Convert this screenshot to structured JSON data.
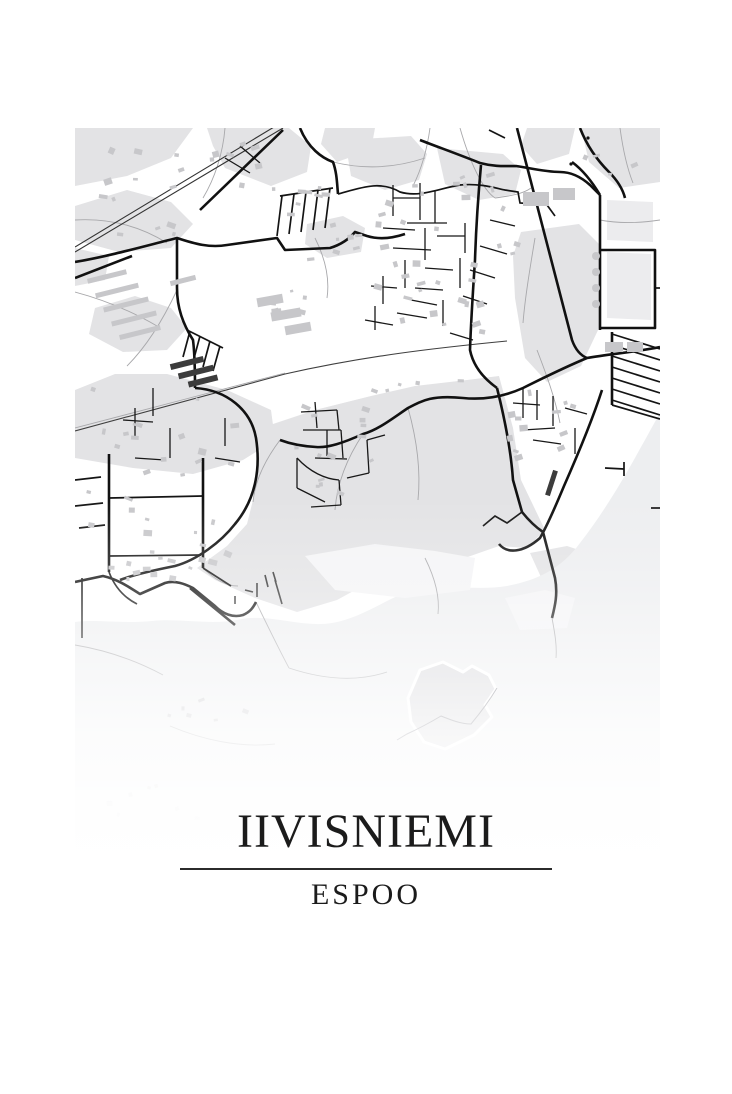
{
  "poster": {
    "title": "IIVISNIEMI",
    "subtitle": "ESPOO"
  },
  "colors": {
    "page": "#ffffff",
    "land": "#ffffff",
    "landuse": "#e3e3e5",
    "landuse_light": "#ececee",
    "water": "#edeef0",
    "shallow": "#f4f4f6",
    "building": "#c7c7ca",
    "building_dark": "#3c3c3c",
    "road_major": "#111111",
    "road_mid": "#141414",
    "road_minor": "#181818",
    "path": "#a8a8ab",
    "railway": "#333333",
    "highway": "#3f3f3f",
    "island_fill": "#d5d5d9",
    "island_trail": "#70707a",
    "pier": "#333333",
    "title_ink": "#1b1b1b",
    "divider": "#2b2b2b"
  },
  "map": {
    "plate": {
      "x": 75,
      "y": 128,
      "w": 585,
      "h": 740
    },
    "landuse": [
      "0,0 118,0 96,30 52,48 0,58",
      "132,0 214,0 236,18 232,44 196,58 150,40 138,18",
      "0,78 52,62 96,74 118,96 96,120 44,124 0,112",
      "250,0 300,0 296,22 262,34 246,16",
      "0,262 40,246 92,246 152,262 196,282 200,312 168,332 118,346 58,340 0,330",
      "270,12 336,8 352,26 344,52 310,62 276,48",
      "362,20 428,26 446,42 440,66 404,72 370,56",
      "296,268 340,258 392,252 424,248 438,300 446,352 470,402 452,420 424,418 384,432 342,438 302,450 262,472 222,484 180,470 140,452 122,440 152,418 172,396 179,368 184,330 186,300 240,282",
      "446,104 504,96 524,116 524,200 506,238 472,254 450,230 440,170 438,128",
      "506,0 585,0 585,54 544,60 514,34",
      "452,0 500,0 494,26 462,36 446,18",
      "20,180 60,168 96,180 112,200 92,222 48,224 14,206",
      "232,96 268,88 290,100 286,124 252,130 230,116",
      "455,425 492,418 522,428 512,453 470,458",
      "0,120 34,128 30,152 0,158"
    ],
    "landuse_light": [
      "532,72 578,74 578,114 532,112",
      "532,124 576,126 576,192 532,190",
      "60,560 140,545 205,562 185,602 100,607 42,590",
      "230,552 292,538 332,558 312,590 252,594",
      "0,600 40,590 70,602 58,632 12,636",
      "120,648 190,640 215,658 195,688 135,690 108,670"
    ],
    "water": "M585,285 C565,320 540,370 505,415 C485,442 462,452 432,458 C402,463 372,456 342,460 C312,470 287,490 257,495 C227,500 197,486 167,491 C137,498 107,490 77,493 C47,496 22,491 0,494 L0,740 L585,740 Z",
    "shallow": [
      "230,428 300,416 360,423 400,430 395,462 330,470 260,462",
      "430,470 470,462 500,470 492,500 445,502"
    ],
    "paths_thin": [
      "M0,92 C35,90 65,98 92,115",
      "M150,0 C148,25 140,50 128,70",
      "M258,34 C290,42 320,40 350,30",
      "M355,0 C352,22 346,42 338,58",
      "M385,0 C395,35 408,62 420,70",
      "M525,92 C545,96 565,95 585,92",
      "M0,164 C30,172 58,184 82,198",
      "M102,162 C88,192 72,218 52,238",
      "M288,306 C272,330 262,355 260,382",
      "M333,280 C342,312 346,342 343,372",
      "M205,312 C190,332 180,352 178,374",
      "M181,474 C196,505 206,525 214,540",
      "M214,540 C250,552 282,554 312,544",
      "M462,222 C472,248 480,270 485,295",
      "M0,517 C30,522 60,532 88,547",
      "M95,598 C128,612 165,620 200,616",
      "M545,0 C548,22 552,40 558,55",
      "M128,440 C140,452 152,458 163,458",
      "M0,300 C70,282 140,263 210,245",
      "M240,110 C250,130 255,150 252,170",
      "M420,70 C435,68 448,66 456,60",
      "M350,430 C360,450 365,468 363,486",
      "M460,110 C455,140 450,170 448,195",
      "M477,490 C480,506 482,518 481,530"
    ],
    "highway": [
      "M0,303 L210,246 C290,228 360,220 432,213"
    ],
    "railway": [
      "M0,124 L208,0",
      "M0,119 L204,-4"
    ],
    "roads_major": [
      "M0,134 C35,128 70,118 102,110 C120,116 135,120 152,117 L202,110 L210,122 L255,120 C268,116 275,110 280,104 L292,108 C305,112 318,110 330,106",
      "M102,110 L102,160 C102,180 108,196 118,212 C120,228 120,244 120,260",
      "M120,260 C152,262 176,282 181,310 C186,342 180,372 160,396 C146,414 122,432 100,438 C75,443 55,448 45,452",
      "M442,0 L497,212 Q502,226 512,230",
      "M585,219 C560,224 535,226 512,230 C488,240 468,250 448,260 C428,269 408,272 388,270 C358,267 348,272 333,280 C318,290 303,302 288,306 C268,315 253,320 241,319 C223,318 213,315 205,312",
      "M406,37 C403,70 401,100 400,132 C398,162 396,192 395,222 C398,237 408,250 422,260",
      "M422,260 C430,292 436,322 438,352 L447,384 C455,394 462,400 468,404 L480,450 C483,466 480,478 477,490",
      "M345,12 C360,18 380,25 405,35 C420,39 430,38 441,38 C455,40 470,44 485,44 C495,44 505,48 515,57 L525,67",
      "M525,67 L525,202",
      "M525,122 L580,122 L580,200 L525,200",
      "M525,67 C515,50 505,40 497,34",
      "M225,0 C233,20 247,30 258,34 C262,45 262,56 263,66",
      "M527,262 C518,290 504,324 489,358 C479,382 472,398 465,410 C448,425 432,426 424,416",
      "M125,82 L208,2",
      "M0,150 L57,128",
      "M0,454 L28,448 C45,452 55,460 65,466 L90,455 C100,452 110,456 118,460 L140,478 C148,486 158,490 168,487 C175,484 178,480 181,474",
      "M115,460 L160,497",
      "M34,326 L34,444",
      "M128,330 L128,440",
      "M505,0 C512,18 522,32 534,44 C544,54 548,62 550,70",
      "M537,204 L537,277"
    ],
    "roads_mid": [
      "M263,66 C285,60 305,52 325,64 C345,70 365,60 385,57 C405,55 420,60 430,62 L443,64 L445,75 L472,77 L480,88",
      "M34,370 L128,368",
      "M34,428 L126,427",
      "M128,440 L156,458",
      "M34,444 C40,460 50,470 62,476",
      "M0,352 L26,349",
      "M0,378 L28,375",
      "M4,400 L30,397",
      "M580,160 L585,160",
      "M537,277 L585,291",
      "M537,206 L585,221",
      "M537,217 L585,232",
      "M537,228 L585,243",
      "M537,239 L585,254",
      "M537,250 L585,265",
      "M537,261 L585,276",
      "M537,272 L585,287",
      "M205,68 L258,60",
      "M207,68 L202,108",
      "M219,66 L214,106",
      "M231,64 L226,104",
      "M243,62 L238,102",
      "M255,60 L250,100",
      "M112,202 L148,220",
      "M115,203 L108,229",
      "M125,208 L118,234",
      "M135,213 L128,239",
      "M145,218 L138,243",
      "M7,450 L7,510",
      "M530,340 L549,341",
      "M549,334 L549,348",
      "M576,380 L587,380",
      "M430,10 L414,2",
      "M447,384 L432,395 L420,388 L408,398"
    ],
    "roads_minor": [
      "M318,57 L318,88",
      "M318,70 L345,70",
      "M345,55 L345,92",
      "M360,62 L360,95",
      "M332,95 L372,95",
      "M308,100 L340,102",
      "M350,100 L350,132",
      "M362,108 L390,108",
      "M390,95 L390,125",
      "M318,120 L356,122",
      "M330,132 L330,160",
      "M350,140 L378,142",
      "M385,130 L385,160",
      "M308,148 L308,176",
      "M296,158 L322,160",
      "M340,160 L368,162",
      "M395,142 L420,150",
      "M405,118 L432,126",
      "M415,92 L440,98",
      "M336,172 L362,177",
      "M322,185 L352,190",
      "M368,172 L368,198",
      "M388,168 L412,176",
      "M300,178 L300,202",
      "M290,192 L318,197",
      "M375,205 L398,212",
      "M448,260 L448,290",
      "M438,275 L465,277",
      "M462,262 L462,292",
      "M478,268 L478,298",
      "M448,302 L480,300",
      "M490,280 L512,286",
      "M458,312 L486,316",
      "M500,300 L500,326",
      "M240,274 L242,300",
      "M226,284 L262,282",
      "M262,282 L264,302",
      "M228,302 L266,302",
      "M266,302 L268,330",
      "M240,330 L272,331",
      "M222,330 C235,344 250,351 264,352",
      "M222,330 L222,360",
      "M222,360 L250,374",
      "M264,352 L266,377",
      "M266,377 L236,379",
      "M292,312 L294,345",
      "M294,345 L272,350",
      "M292,312 L310,307",
      "M252,302 L252,328",
      "M60,280 L60,310",
      "M48,292 L78,294",
      "M78,260 L78,288",
      "M95,300 L95,330",
      "M60,330 L90,332",
      "M150,290 L150,318",
      "M140,330 L165,334",
      "M150,30 L175,45",
      "M165,18 L185,35"
    ],
    "piers": [
      "M182,455 L182,469",
      "M190,447 L193,459",
      "M198,444 L201,454",
      "M170,462 L178,464",
      "M160,468 L160,476",
      "M200,452 L207,476"
    ],
    "bars": [
      [
        474,
        342,
        5,
        26,
        18
      ],
      [
        95,
        232,
        34,
        6,
        -14
      ],
      [
        103,
        241,
        36,
        6,
        -14
      ],
      [
        113,
        250,
        30,
        6,
        -14
      ]
    ],
    "tanks": [
      [
        521,
        128
      ],
      [
        521,
        144
      ],
      [
        521,
        160
      ],
      [
        521,
        176
      ]
    ],
    "dots": [
      [
        513,
        10
      ],
      [
        496,
        36
      ]
    ],
    "island": {
      "outline": "345,542 368,534 388,544 397,538 414,547 421,561 410,577 417,589 399,607 370,621 349,614 336,594 333,570",
      "trail": "M322,612 L332,606 C345,600 356,594 366,588 C376,592 386,596 396,596 C406,584 416,570 422,560"
    },
    "building_clusters": [
      [
        8,
        6,
        112,
        104,
        13,
        6,
        4
      ],
      [
        128,
        14,
        66,
        50,
        7,
        6,
        4
      ],
      [
        196,
        58,
        64,
        40,
        8,
        6,
        3
      ],
      [
        232,
        94,
        56,
        44,
        7,
        5,
        3
      ],
      [
        296,
        38,
        156,
        170,
        36,
        6,
        4
      ],
      [
        432,
        258,
        92,
        78,
        12,
        6,
        4
      ],
      [
        6,
        250,
        166,
        196,
        30,
        6,
        4
      ],
      [
        217,
        277,
        98,
        102,
        14,
        6,
        3
      ],
      [
        16,
        428,
        120,
        26,
        9,
        5,
        3
      ],
      [
        288,
        242,
        114,
        24,
        5,
        5,
        3
      ],
      [
        22,
        652,
        116,
        40,
        7,
        4,
        3
      ],
      [
        352,
        556,
        46,
        40,
        5,
        3,
        2
      ],
      [
        506,
        8,
        62,
        40,
        5,
        6,
        4
      ],
      [
        180,
        160,
        58,
        38,
        6,
        8,
        5
      ],
      [
        80,
        560,
        100,
        36,
        6,
        4,
        3
      ]
    ],
    "buildings": [
      [
        12,
        146,
        40,
        5,
        -14
      ],
      [
        20,
        160,
        44,
        5,
        -14
      ],
      [
        28,
        174,
        46,
        5,
        -14
      ],
      [
        36,
        188,
        46,
        5,
        -14
      ],
      [
        44,
        202,
        42,
        5,
        -14
      ],
      [
        95,
        150,
        26,
        5,
        -14
      ],
      [
        182,
        168,
        26,
        9,
        -10
      ],
      [
        196,
        182,
        30,
        9,
        -10
      ],
      [
        210,
        196,
        26,
        9,
        -10
      ],
      [
        448,
        64,
        26,
        14,
        0
      ],
      [
        478,
        60,
        22,
        12,
        0
      ],
      [
        530,
        214,
        18,
        10,
        0
      ],
      [
        552,
        214,
        16,
        10,
        0
      ]
    ],
    "fade_stops": [
      [
        0.5,
        0
      ],
      [
        0.62,
        0.25
      ],
      [
        0.72,
        0.55
      ],
      [
        0.82,
        0.82
      ],
      [
        0.92,
        0.95
      ],
      [
        1,
        1
      ]
    ]
  }
}
